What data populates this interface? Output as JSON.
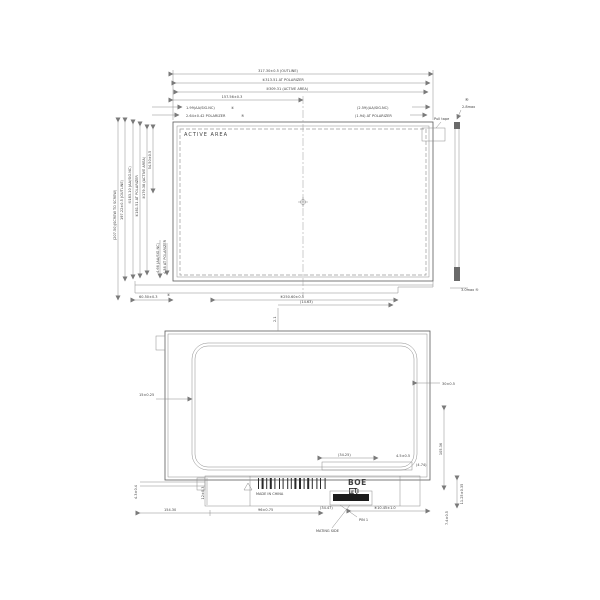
{
  "front_view": {
    "active_area": "ACTIVE  AREA",
    "dim_outline_w": "317.30±0.5 (OUTLINE)",
    "dim_polarizer_w": "④313.51 AT POLARIZER",
    "dim_active_w": "③309.31 (ACTIVE AREA)",
    "dim_half_w": "157.56±0.3",
    "dim_left_aa": "1.99(AA/SIG.NC)",
    "dim_left_aa_ref": "④",
    "dim_left_pol": "2.64±0.42 POLARIZER",
    "dim_left_pol_ref": "⑤",
    "dim_right_aa": "(2.59)(AA/SIG.NC)",
    "dim_right_pol": "(1.94) AT POLARIZER",
    "pull_tape": "Pull tape",
    "dim_screw_h": "(207.50)(SCREW TO SCREW)",
    "dim_outline_h": "197.22±0.5 (OUTLINE)",
    "dim_sig_h": "⑤183.10 (AA/SIG.NC)",
    "dim_pol_h": "④181.51 AT POLARIZER",
    "dim_active_h": "③179.38 (ACTIVE AREA)",
    "dim_top_offset": "54.50±0.5",
    "dim_bot_aa": "4.66 (AA/SIG.NC)",
    "dim_bot_pol": "4.38 AT POLARIZER",
    "dim_bottom_left": "60.50±0.3",
    "datum_a": "④",
    "dim_bottom_center": "⑥250.60±0.5",
    "side_top_ref": "④",
    "side_top": "2.8max",
    "side_bottom": "3.0max ⑤"
  },
  "rear_view": {
    "dim_top": "(14.63)",
    "dim_top_tick": "2.1",
    "dim_left": "15±0.25",
    "dim_right_gap": "30±0.5",
    "dim_right_h": "105.36",
    "dim_conn_edge": "11.25±0.35",
    "dim_conn_h": "7.4±0.5",
    "dim_inner1": "4.5±0.5",
    "dim_inner2": "(4.74)",
    "dim_fpc": "(34.25)",
    "dim_bot1": "154.30",
    "dim_bot2": "96±0.75",
    "dim_conn_w": "(34.47)",
    "dim_conn_pos": "⑥10.45±1.0",
    "dim_pcb_h": "12±0.3",
    "dim_rail": "4.3±0.4",
    "made_in": "MADE IN CHINA",
    "logo": "BOE",
    "mating": "MATING SIDE",
    "pin1": "PIN 1"
  }
}
